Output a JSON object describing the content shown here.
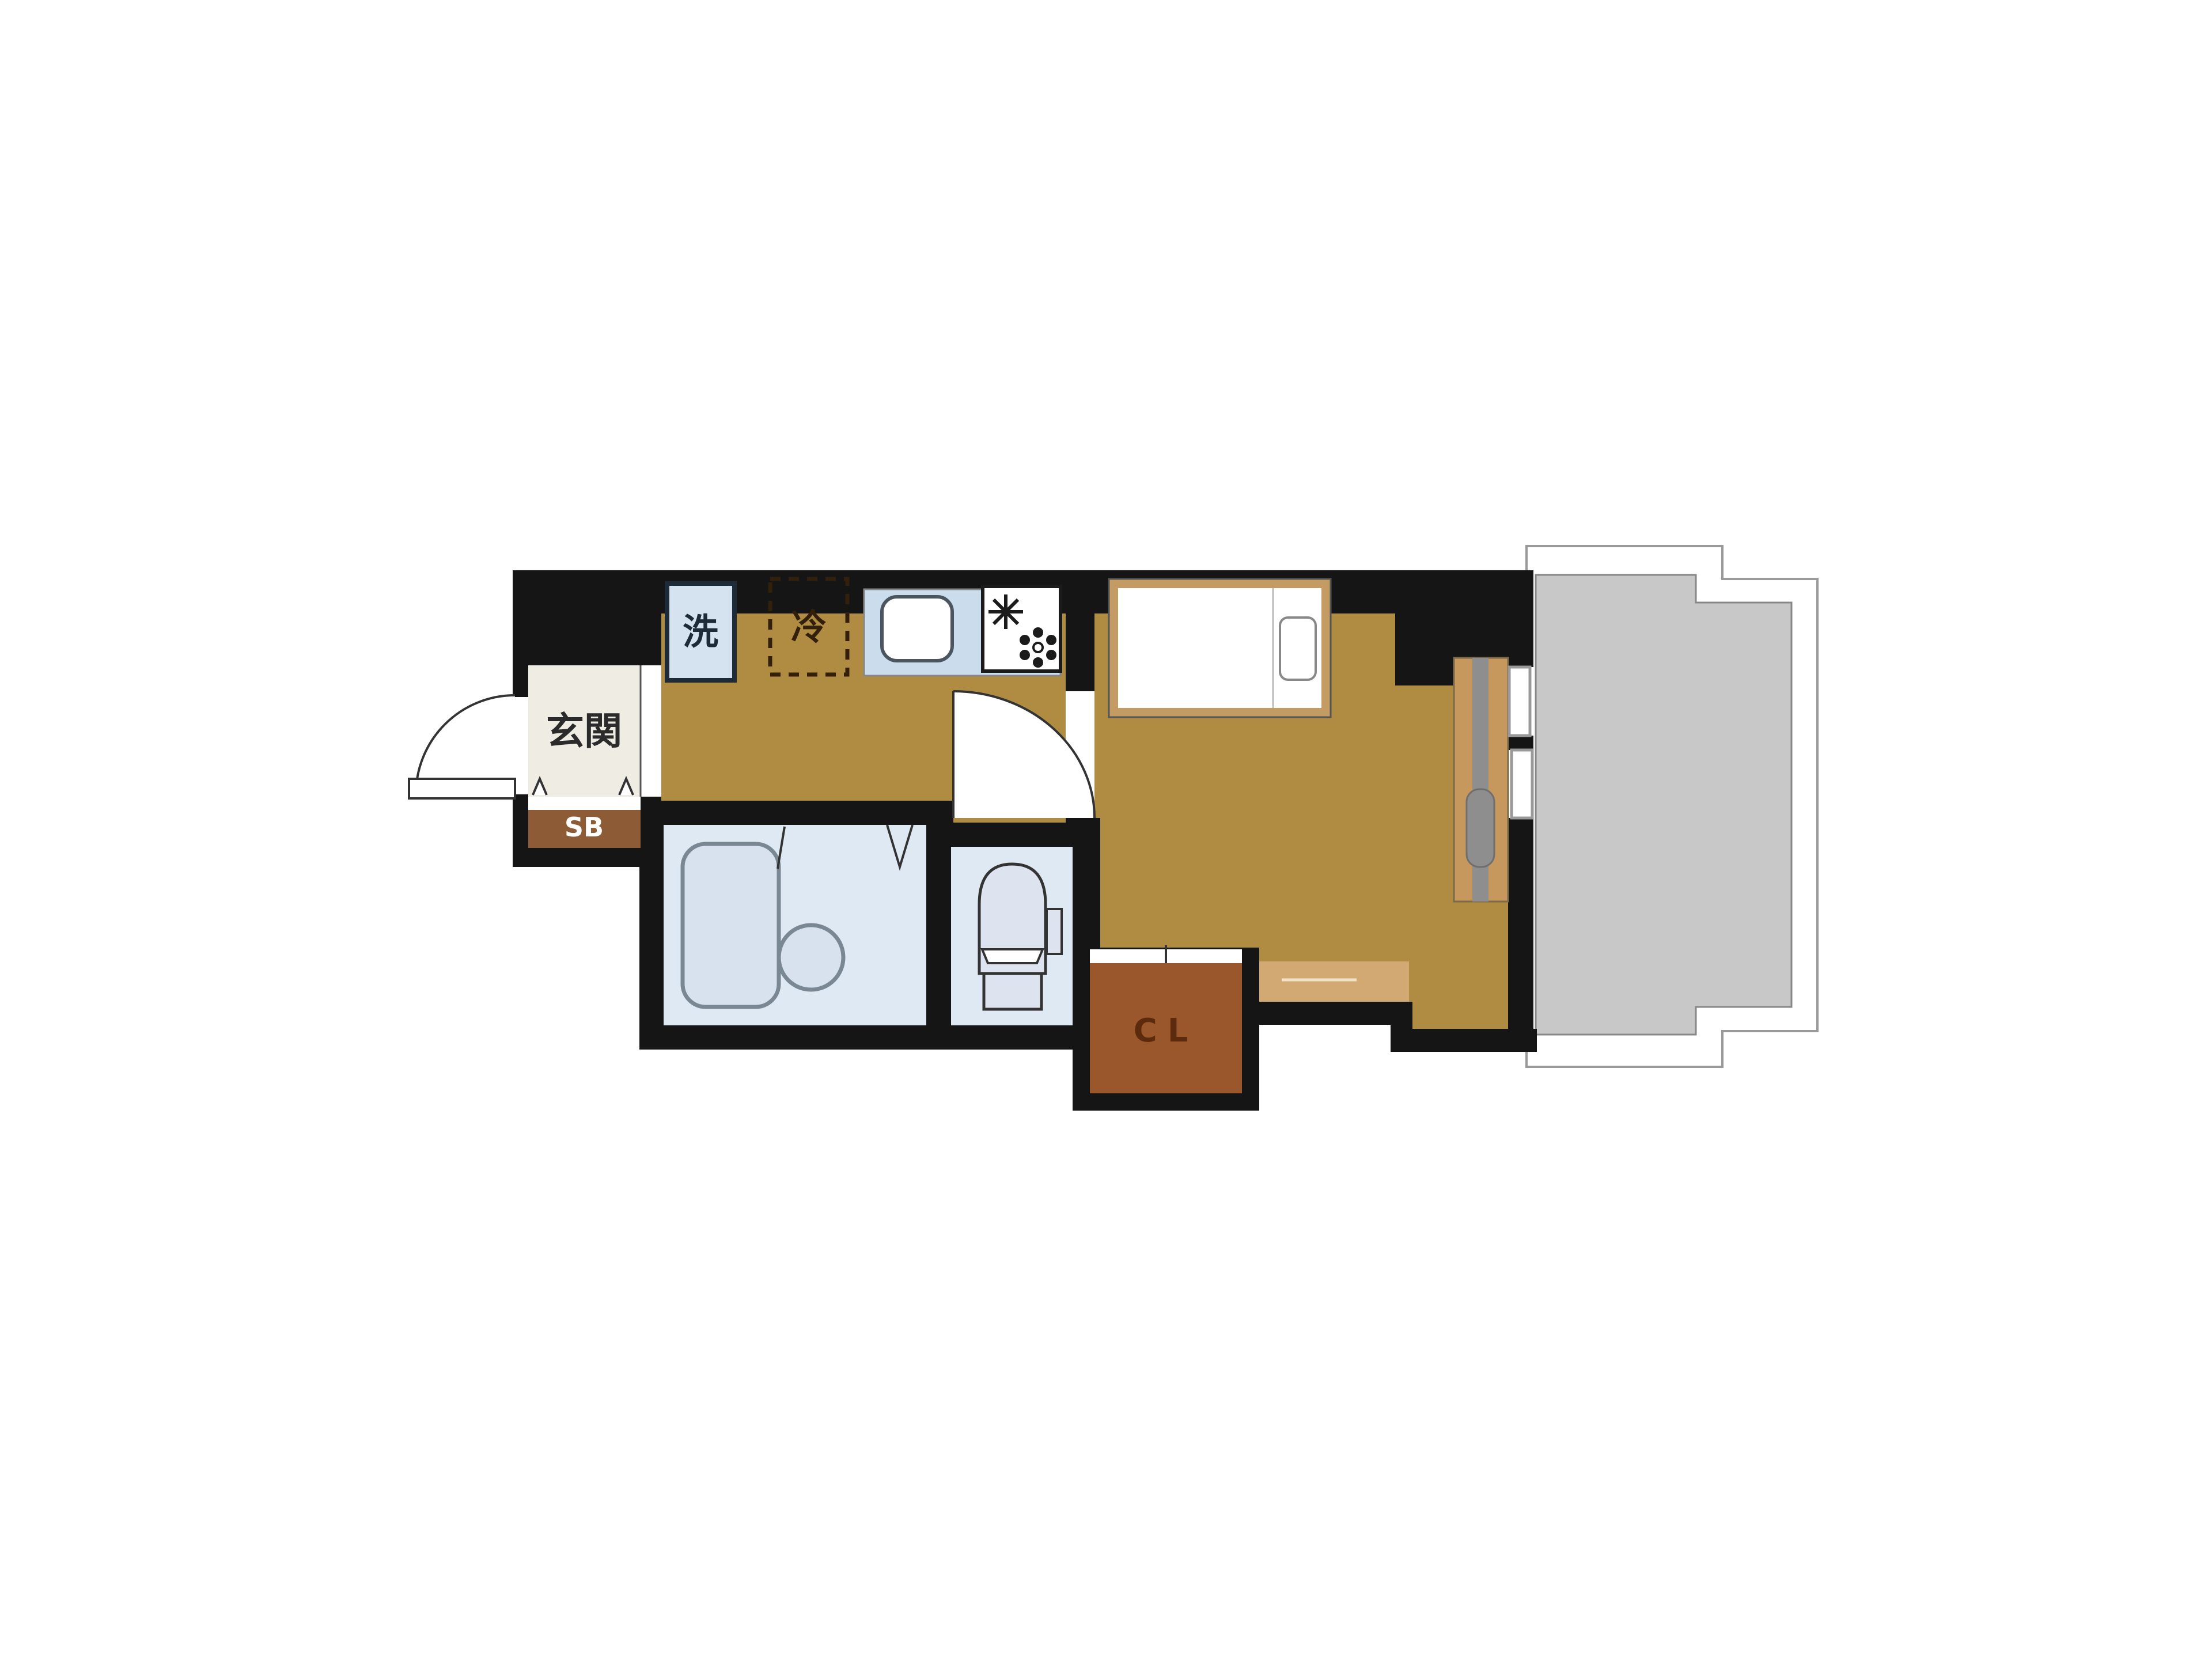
{
  "plan": {
    "type": "apartment-floor-plan",
    "labels": {
      "entrance": "玄関",
      "shoe_box": "SB",
      "washer": "洗",
      "refrigerator": "冷",
      "closet": "CL"
    },
    "colors": {
      "wall": "#151515",
      "floor": "#B08C42",
      "floor_step": "#D2A873",
      "entrance_floor": "#EFECE4",
      "shoe_box": "#8D5B35",
      "shoe_box_text": "#ffffff",
      "closet": "#9A572B",
      "closet_text": "#5C2A0C",
      "water_room": "#DEE9F3",
      "fixture_fill": "#D8E2EE",
      "counter": "#CBDDEC",
      "washer_box": "#D5E3F1",
      "washer_text": "#1D2B38",
      "fridge_text": "#33200A",
      "balcony": "#C8C8C8",
      "bed_frame": "#C49B63",
      "window_sash": "#C6985E",
      "label_dark": "#2B2B2B"
    }
  }
}
